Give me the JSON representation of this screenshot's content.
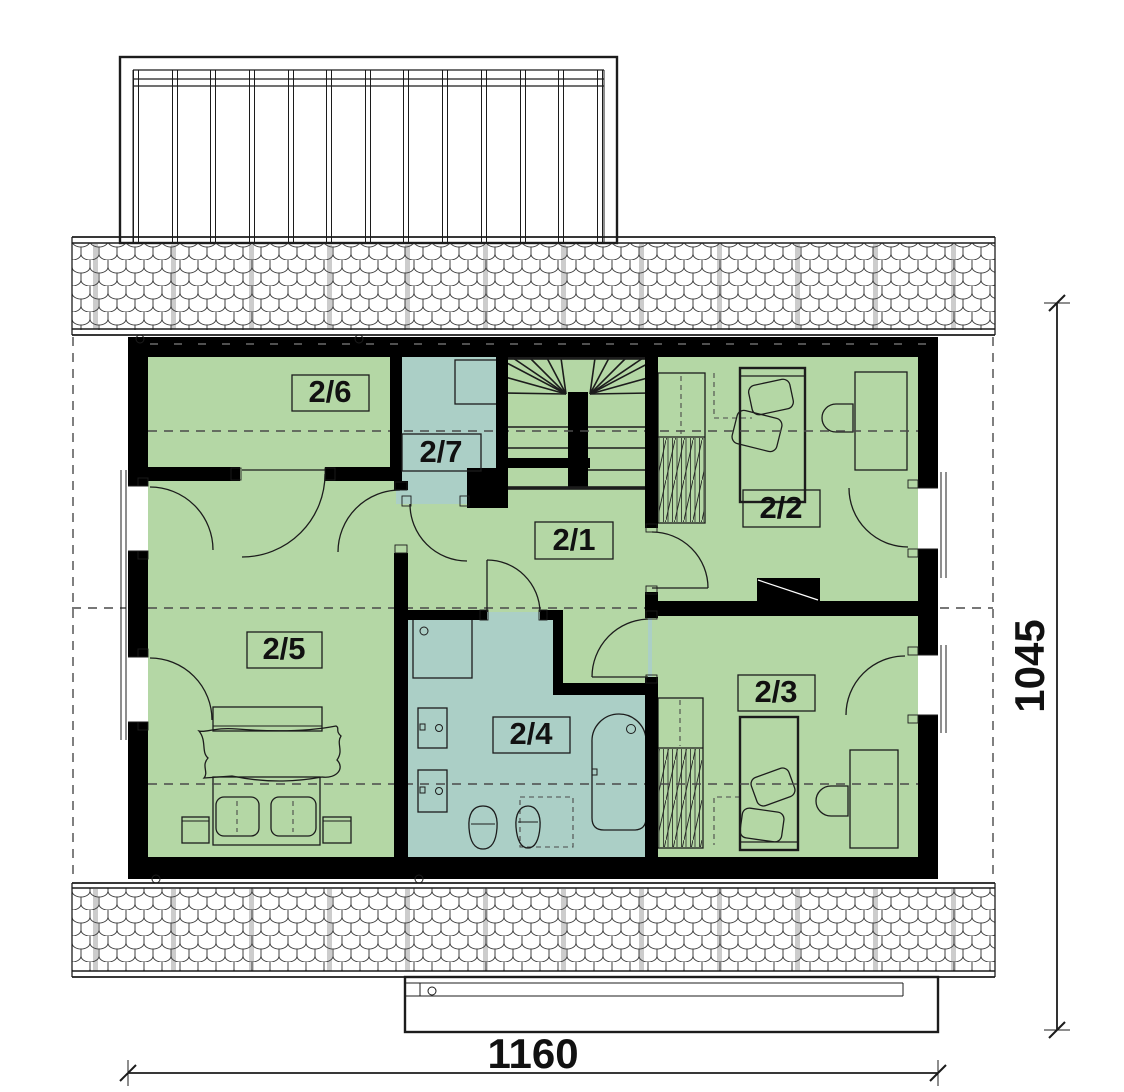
{
  "plan": {
    "type": "floor-plan",
    "rooms": [
      {
        "label": "2/1",
        "kind": "hall"
      },
      {
        "label": "2/2",
        "kind": "bedroom"
      },
      {
        "label": "2/3",
        "kind": "bedroom"
      },
      {
        "label": "2/4",
        "kind": "bathroom"
      },
      {
        "label": "2/5",
        "kind": "bedroom"
      },
      {
        "label": "2/6",
        "kind": "room"
      },
      {
        "label": "2/7",
        "kind": "closet"
      }
    ],
    "dimensions": {
      "width": "1160",
      "height": "1045"
    },
    "colors": {
      "green": "#b4d7a5",
      "blue": "#abcfc6",
      "wall": "#000000",
      "line": "#1c1c1c",
      "dash": "#4a4a4a",
      "paper": "#ffffff",
      "gray_stripe": "#cccccc"
    }
  }
}
